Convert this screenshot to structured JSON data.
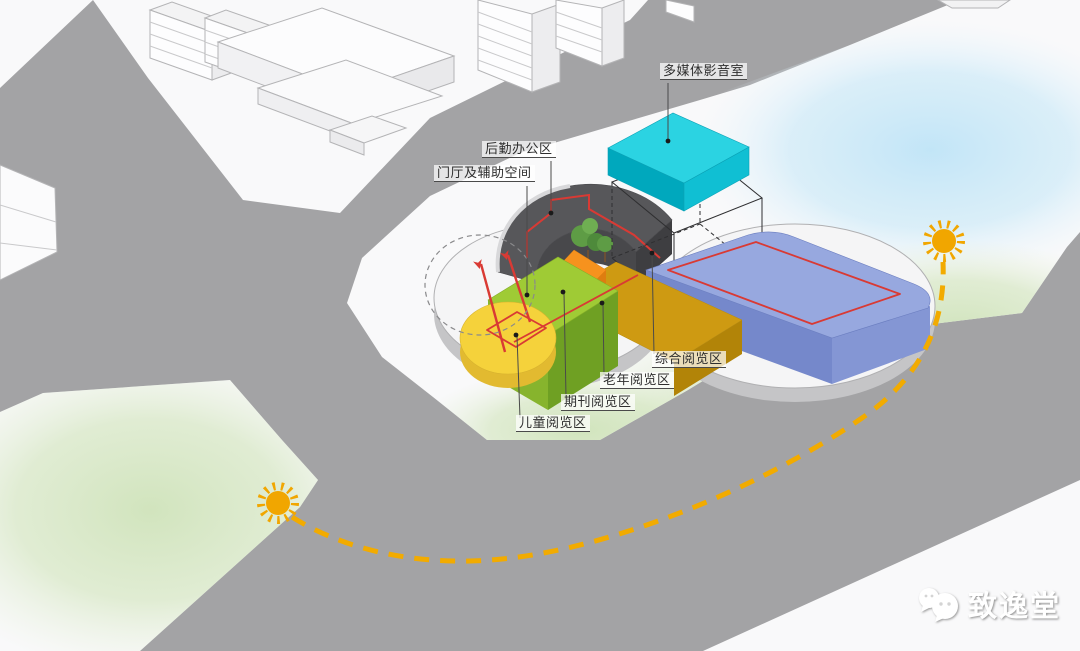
{
  "scene": {
    "description": "axonometric site diagram of a library massing with functional zones",
    "annotations": [
      {
        "id": "multimedia-room",
        "text": "多媒体影音室",
        "zone_color": "#1fc9dc"
      },
      {
        "id": "logistics-office",
        "text": "后勤办公区",
        "zone_color": "#57575a"
      },
      {
        "id": "lobby-auxiliary",
        "text": "门厅及辅助空间",
        "zone_color": "#9fcb35"
      },
      {
        "id": "general-reading",
        "text": "综合阅览区",
        "zone_color": "#97a8df"
      },
      {
        "id": "elderly-reading",
        "text": "老年阅览区",
        "zone_color": "#ce9a12"
      },
      {
        "id": "periodical-reading",
        "text": "期刊阅览区",
        "zone_color": "#f6921e"
      },
      {
        "id": "children-reading",
        "text": "儿童阅览区",
        "zone_color": "#f5d23b"
      }
    ],
    "sun": {
      "icon": "sun-icon",
      "color": "#f1a600",
      "path_color": "#f2ab00"
    },
    "circulation_color": "#d93a34",
    "road_color": "#a3a3a5"
  },
  "watermark": {
    "brand": "致逸堂",
    "icon": "wechat-logo"
  }
}
